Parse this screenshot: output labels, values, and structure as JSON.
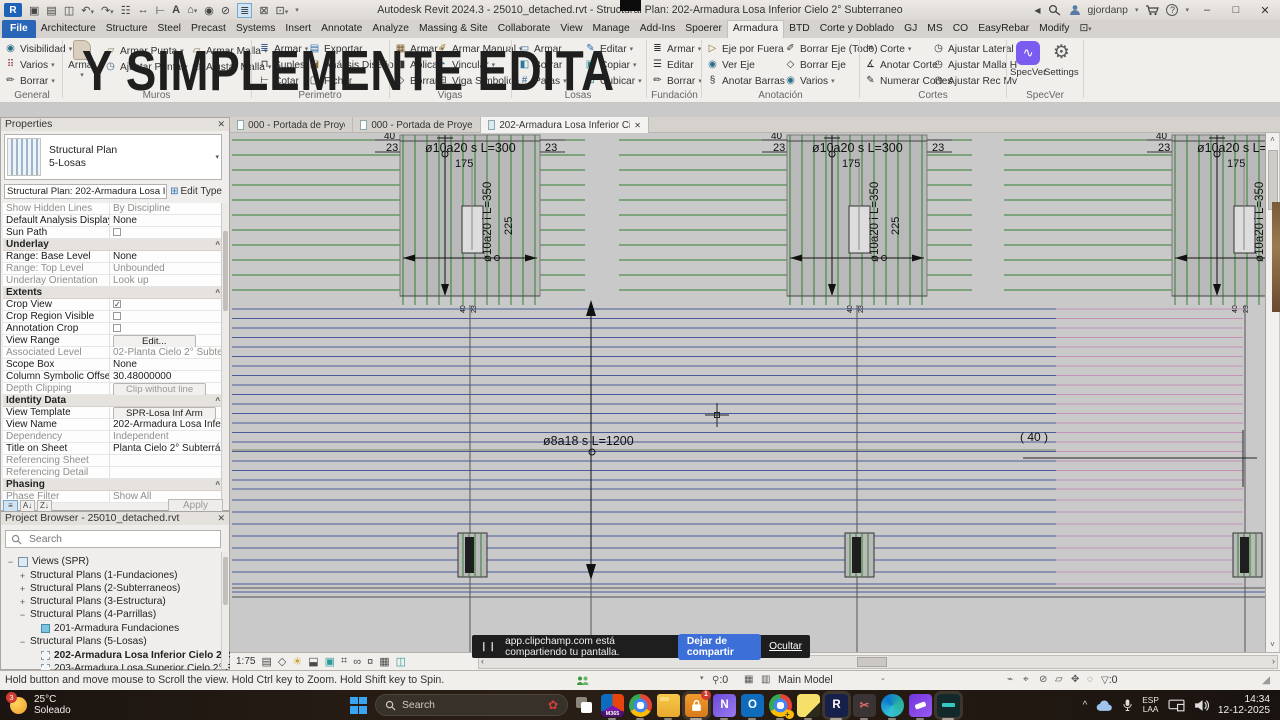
{
  "overlay": {
    "caption": "Y SIMPLEMENTE EDITA"
  },
  "titlebar": {
    "title": "Autodesk Revit 2024.3 - 25010_detached.rvt - Structural Plan: 202-Armadura  Losa Inferior Cielo 2° Subterraneo",
    "user": "gjordanp"
  },
  "tabs": [
    "File",
    "Architecture",
    "Structure",
    "Steel",
    "Precast",
    "Systems",
    "Insert",
    "Annotate",
    "Analyze",
    "Massing & Site",
    "Collaborate",
    "View",
    "Manage",
    "Add-Ins",
    "Spoerer",
    "Armadura",
    "BTD",
    "Corte y Doblado",
    "GJ",
    "MS",
    "CO",
    "EasyRebar",
    "Modify"
  ],
  "ribbon": {
    "general": {
      "label": "General",
      "b": [
        "Visibilidad",
        "Varios",
        "Borrar"
      ]
    },
    "muros": {
      "label": "Muros",
      "big": "Armar",
      "b": [
        "Armar Punta",
        "Ajustar Punta",
        "Armar Malla",
        "Ajustar Malla"
      ]
    },
    "perimetro": {
      "label": "Perimetro",
      "b": [
        "Armar",
        "Suples",
        "Cotar",
        "Exportar",
        "Análisis Diseño",
        "Fichar"
      ]
    },
    "vigas": {
      "label": "Vigas",
      "b": [
        "Armar",
        "Aplicar",
        "Borrar",
        "Armar Manual",
        "Vincular",
        "Viga Simbolica"
      ]
    },
    "losas": {
      "label": "Losas",
      "b": [
        "Armar",
        "Borrar",
        "Patas",
        "Editar",
        "Copiar",
        "Cubicar"
      ]
    },
    "fundacion": {
      "label": "Fundación",
      "b": [
        "Armar",
        "Editar",
        "Borrar"
      ]
    },
    "anotacion": {
      "label": "Anotación",
      "b": [
        "Eje por Fuera",
        "Ver Eje",
        "Anotar Barras",
        "Borrar Eje (Todo)",
        "Borrar Eje",
        "Varios"
      ]
    },
    "cortes": {
      "label": "Cortes",
      "b": [
        "Corte",
        "Anotar Corte",
        "Numerar Cortes",
        "Ajustar Lateral",
        "Ajustar Malla H",
        "Ajustar Rec Mv"
      ]
    },
    "specver": {
      "label": "SpecVer",
      "b": [
        "SpecVer",
        "Settings"
      ]
    }
  },
  "properties": {
    "title": "Properties",
    "type_name": "Structural Plan",
    "type_sub": "5-Losas",
    "selector": "Structural Plan: 202-Armadura  Losa Inferior C",
    "edit_type": "Edit Type",
    "headers": [
      "Underlay",
      "Extents",
      "Identity Data",
      "Phasing"
    ],
    "rows": [
      {
        "l": "Show Hidden Lines",
        "v": "By Discipline"
      },
      {
        "l": "Default Analysis Display St...",
        "v": "None"
      },
      {
        "l": "Sun Path",
        "v": ""
      },
      {
        "l": "Range: Base Level",
        "v": "None"
      },
      {
        "l": "Range: Top Level",
        "v": "Unbounded"
      },
      {
        "l": "Underlay Orientation",
        "v": "Look up"
      },
      {
        "l": "Crop View",
        "v": ""
      },
      {
        "l": "Crop Region Visible",
        "v": ""
      },
      {
        "l": "Annotation Crop",
        "v": ""
      },
      {
        "l": "View Range",
        "v": "Edit..."
      },
      {
        "l": "Associated Level",
        "v": "02-Planta Cielo 2° Subterra..."
      },
      {
        "l": "Scope Box",
        "v": "None"
      },
      {
        "l": "Column Symbolic Offset",
        "v": "30.48000000"
      },
      {
        "l": "Depth Clipping",
        "v": "Clip without line"
      },
      {
        "l": "View Template",
        "v": "SPR-Losa Inf Arm"
      },
      {
        "l": "View Name",
        "v": "202-Armadura  Losa Inferio..."
      },
      {
        "l": "Dependency",
        "v": "Independent"
      },
      {
        "l": "Title on Sheet",
        "v": "Planta Cielo 2° Subterráneo"
      },
      {
        "l": "Referencing Sheet",
        "v": ""
      },
      {
        "l": "Referencing Detail",
        "v": ""
      },
      {
        "l": "Phase Filter",
        "v": "Show All"
      }
    ],
    "apply": "Apply"
  },
  "browser": {
    "title": "Project Browser - 25010_detached.rvt",
    "search": "Search",
    "tree": [
      "Views (SPR)",
      "Structural Plans (1-Fundaciones)",
      "Structural Plans (2-Subterraneos)",
      "Structural Plans (3-Estructura)",
      "Structural Plans (4-Parrillas)",
      "201-Armadura Fundaciones",
      "Structural Plans (5-Losas)",
      "202-Armadura Losa Inferior Cielo 2° Subterra",
      "203-Armadura Losa Superior Cielo 2° Subterran"
    ]
  },
  "viewtabs": [
    "000 - Portada de Proyecto",
    "000 - Portada de Proyecto",
    "202-Armadura  Losa Inferior Ciel..."
  ],
  "drawing": {
    "zone": {
      "d40": "40",
      "d23": "23",
      "top": "ø10a20 s L=300",
      "d175": "175",
      "vside": "ø10a20 i L=350",
      "v225": "225"
    },
    "mid": {
      "rebar": "ø8a18 s L=1200",
      "forty": "( 40 )"
    },
    "scale": "1:75"
  },
  "statusbar": {
    "hint": "Hold button and move mouse to Scroll the view. Hold Ctrl key to Zoom. Hold Shift key to Spin.",
    "workset_badge": ":0",
    "main_model": "Main Model",
    "filter_badge": ":0"
  },
  "notification": {
    "text": "app.clipchamp.com está compartiendo tu pantalla.",
    "stop": "Dejar de compartir",
    "hide": "Ocultar"
  },
  "taskbar": {
    "temp": "25°C",
    "cond": "Soleado",
    "badge": "3",
    "search": "Search",
    "m365": "M365",
    "lock_badge": "1",
    "lang_top": "ESP",
    "lang_bottom": "LAA",
    "time": "14:34",
    "date": "12-12-2025"
  },
  "colors": {
    "file_tab": "#2a66b8",
    "canvas_green": "#338033",
    "canvas_blue": "#4a5a9b",
    "canvas_pink": "#c48fb8",
    "specver_purple": "#7a5cf0",
    "share_button": "#3d6fd8"
  }
}
